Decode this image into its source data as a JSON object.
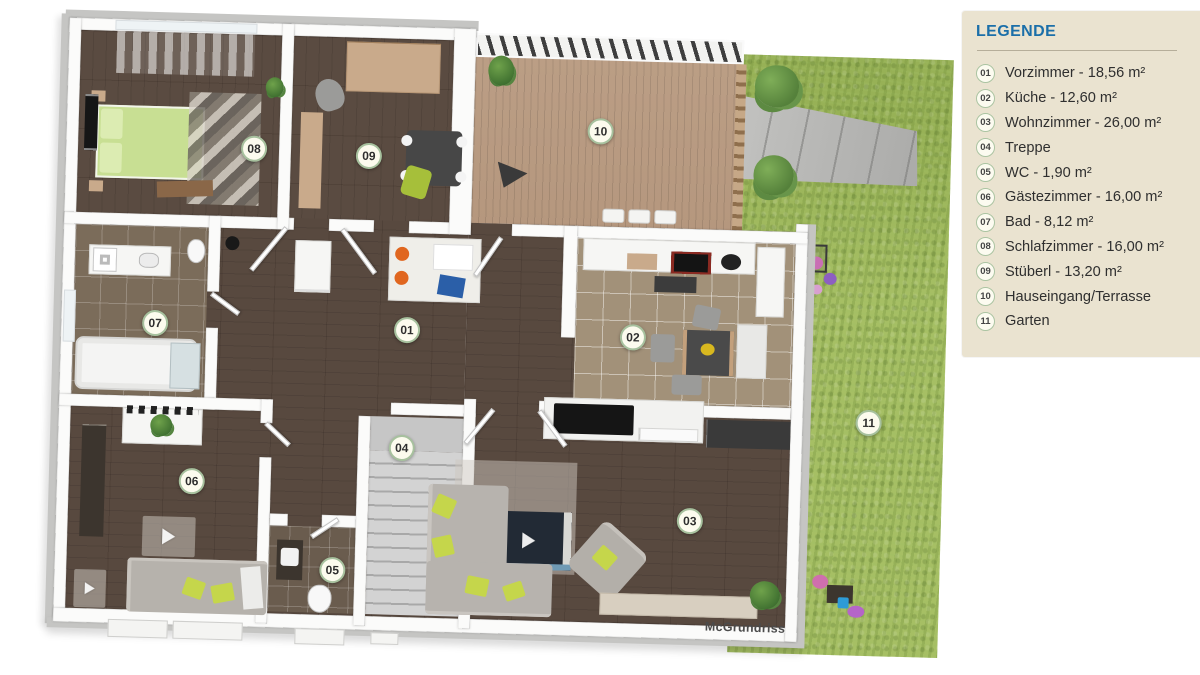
{
  "legend": {
    "title": "LEGENDE",
    "items": [
      {
        "num": "01",
        "label": "Vorzimmer - 18,56 m²"
      },
      {
        "num": "02",
        "label": "Küche - 12,60 m²"
      },
      {
        "num": "03",
        "label": "Wohnzimmer - 26,00 m²"
      },
      {
        "num": "04",
        "label": "Treppe"
      },
      {
        "num": "05",
        "label": "WC - 1,90 m²"
      },
      {
        "num": "06",
        "label": "Gästezimmer - 16,00 m²"
      },
      {
        "num": "07",
        "label": "Bad - 8,12 m²"
      },
      {
        "num": "08",
        "label": "Schlafzimmer - 16,00 m²"
      },
      {
        "num": "09",
        "label": "Stüberl - 13,20 m²"
      },
      {
        "num": "10",
        "label": "Hauseingang/Terrasse"
      },
      {
        "num": "11",
        "label": "Garten"
      }
    ]
  },
  "markers": [
    {
      "num": "01",
      "x": 366,
      "y": 315
    },
    {
      "num": "02",
      "x": 592,
      "y": 316
    },
    {
      "num": "03",
      "x": 654,
      "y": 498
    },
    {
      "num": "04",
      "x": 364,
      "y": 433
    },
    {
      "num": "05",
      "x": 298,
      "y": 557
    },
    {
      "num": "06",
      "x": 155,
      "y": 472
    },
    {
      "num": "07",
      "x": 114,
      "y": 315
    },
    {
      "num": "08",
      "x": 208,
      "y": 138
    },
    {
      "num": "09",
      "x": 323,
      "y": 142
    },
    {
      "num": "10",
      "x": 554,
      "y": 111
    },
    {
      "num": "11",
      "x": 830,
      "y": 395
    }
  ],
  "watermark": "McGrundriss",
  "colors": {
    "legend_bg": "#EAE3D0",
    "legend_title": "#1B6FA9",
    "marker_bg": "#FCFBEE",
    "marker_border": "#A7C19E",
    "grass": "#A6BF64",
    "deck": "#B5977E",
    "wood_floor": "#57483F",
    "wall": "#FBFBFA"
  }
}
